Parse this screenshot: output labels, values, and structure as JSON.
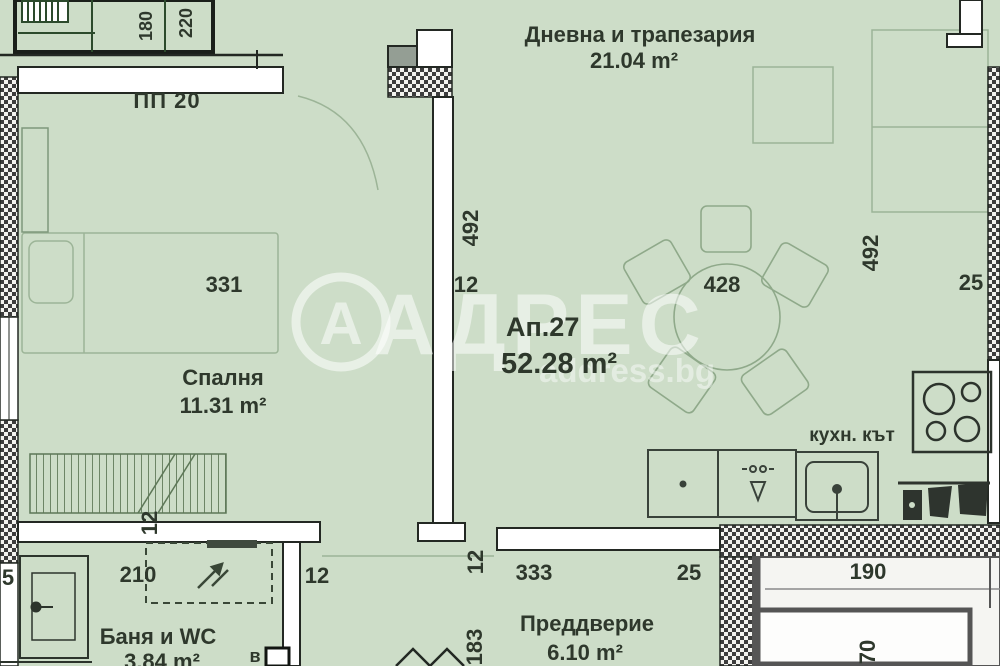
{
  "plan_title": "Floor plan of apartment Ап.27",
  "watermark": {
    "logo_letter": "А",
    "brand": "АДРЕС",
    "site": "address.bg"
  },
  "labels": {
    "pp": "ПП 20",
    "apartment": {
      "name": "Ап.27",
      "area": "52.28 m²"
    },
    "living": {
      "name": "Дневна и трапезария",
      "area": "21.04 m²"
    },
    "bedroom": {
      "name": "Спалня",
      "area": "11.31 m²"
    },
    "bathroom": {
      "name": "Баня и WC",
      "area": "3.84 m²"
    },
    "hallway": {
      "name": "Преддверие",
      "area": "6.10 m²"
    },
    "kitchen": {
      "name": "кухн. кът"
    }
  },
  "dimensions": [
    {
      "text": "180"
    },
    {
      "text": "220"
    },
    {
      "text": "331"
    },
    {
      "text": "492"
    },
    {
      "text": "12"
    },
    {
      "text": "428"
    },
    {
      "text": "492"
    },
    {
      "text": "25"
    },
    {
      "text": "12"
    },
    {
      "text": "210"
    },
    {
      "text": "12"
    },
    {
      "text": "333"
    },
    {
      "text": "25"
    },
    {
      "text": "12"
    },
    {
      "text": "183"
    },
    {
      "text": "190"
    },
    {
      "text": "70"
    },
    {
      "text": "5"
    },
    {
      "text": "в"
    }
  ],
  "colors": {
    "background": "#cdddc8",
    "wall_fill": "#ffffff",
    "wall_stroke": "#232823",
    "hatch_dark": "#3d3d3d",
    "text": "#2e382c",
    "furniture_faint": "#9cb497",
    "watermark": "#ffffff"
  }
}
